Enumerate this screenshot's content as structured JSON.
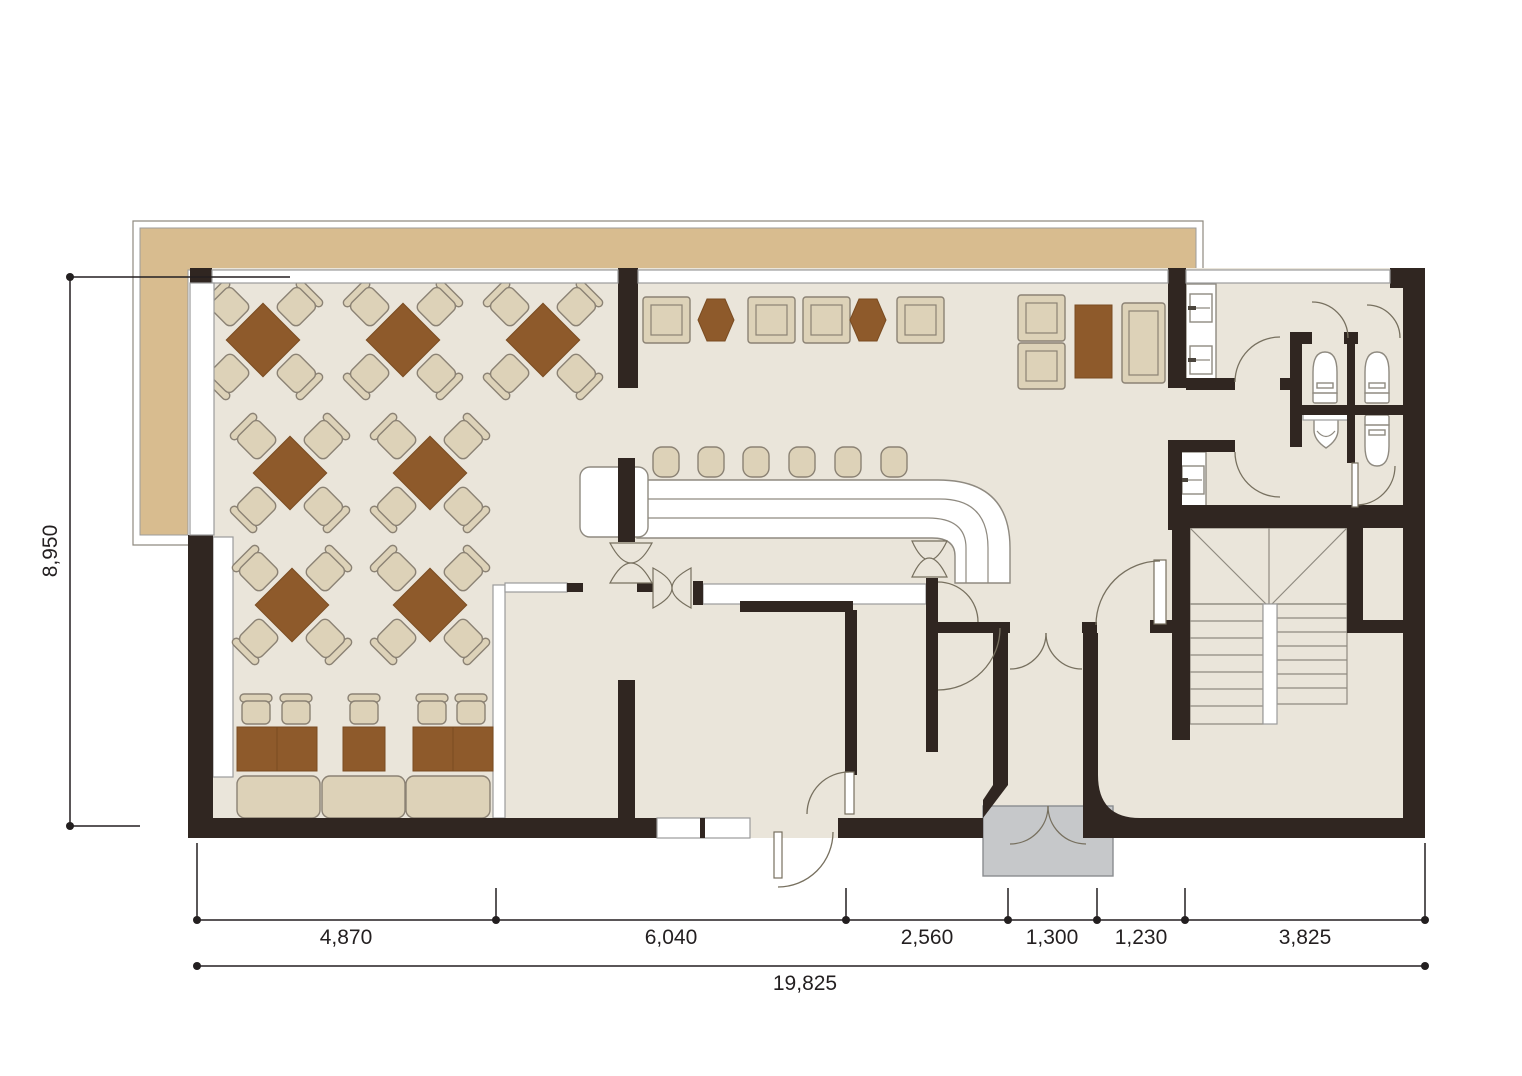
{
  "plan": {
    "type": "restaurant-floor-plan",
    "areas": [
      "terrace",
      "dining-area",
      "lounge",
      "bar",
      "kitchen",
      "restrooms",
      "staircase",
      "entrance"
    ]
  },
  "colors": {
    "wall": "#302621",
    "floor": "#eae5da",
    "terrace": "#d8bc8f",
    "table_brown": "#8e5a2b",
    "seat": "#ddd2b8",
    "seat_stroke": "#8b8274",
    "entry_gray": "#c6c8ca",
    "outline": "#9b9b9b",
    "stair_stroke": "#8f8a80",
    "dim": "#231f20"
  },
  "furniture": {
    "dining_table_sets": 7,
    "booth_tables": 3,
    "booth_chairs": 5,
    "bench_sections": 3,
    "lounge_armchairs": 6,
    "hex_side_tables": 2,
    "bar_stools": 6,
    "toilets": 3,
    "urinals": 1,
    "sinks": 3
  },
  "dimensions": {
    "height": {
      "label": "8,950"
    },
    "segments": [
      {
        "label": "4,870"
      },
      {
        "label": "6,040"
      },
      {
        "label": "2,560"
      },
      {
        "label": "1,300"
      },
      {
        "label": "1,230"
      },
      {
        "label": "3,825"
      }
    ],
    "total": {
      "label": "19,825"
    }
  }
}
